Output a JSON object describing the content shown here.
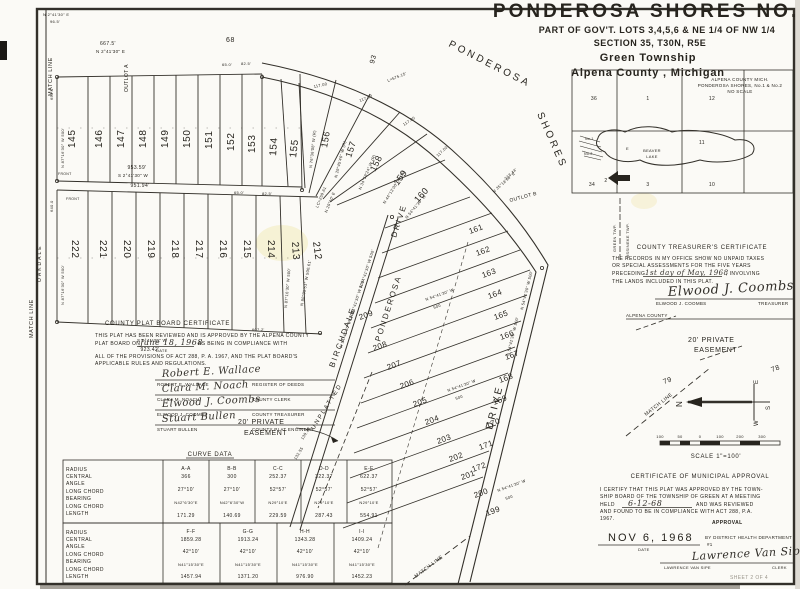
{
  "document": {
    "title_line1": "PONDEROSA   SHORES   NO. 2",
    "title_line2": "PART OF GOV'T. LOTS  3,4,5,6  &  NE 1/4  OF  NW 1/4",
    "title_line3": "SECTION  35,  T30N, R5E",
    "title_line4": "Green   Township",
    "title_line5": "Alpena  County ,  Michigan",
    "sheet_note": "SHEET 2 OF 4"
  },
  "inset_map": {
    "caption1": "ALPENA  COUNTY  MICH.",
    "caption2": "PONDEROSA  SHORES, No.1 & No.2",
    "caption3": "NO SCALE",
    "lake_dir": "E",
    "lake_name1": "BEAVER",
    "lake_name2": "LAKE",
    "plat_no1": "No.1",
    "plat_no2": "No.2",
    "sections": [
      "36",
      "1",
      "12",
      "11",
      "34",
      "2",
      "3",
      "10"
    ]
  },
  "certificates": {
    "treasurer": {
      "heading": "COUNTY  TREASURER'S  CERTIFICATE",
      "body1": "THE RECORDS IN MY OFFICE SHOW NO UNPAID TAXES",
      "body2": "OR SPECIAL ASSESSMENTS FOR THE FIVE YEARS",
      "body3_pre": "PRECEDING",
      "body3_date": "1st day of May, 1968",
      "body3_post": ", INVOLVING",
      "body4": "THE LANDS INCLUDED IN THIS PLAT.",
      "signature": "Elwood J. Coombs",
      "name": "ELWOOD  J.  COOMBS",
      "title": "TREASURER",
      "county": "ALPENA COUNTY"
    },
    "plat_board": {
      "heading": "COUNTY  PLAT  BOARD  CERTIFICATE",
      "body1": "THIS PLAT HAS BEEN REVIEWED AND IS APPROVED BY THE ALPENA COUNTY",
      "body2_pre": "PLAT BOARD ON",
      "body2_date": "June 18, 1968",
      "body2_date_label": "DATE",
      "body2_post": "AS BEING IN COMPLIANCE WITH",
      "body3": "ALL OF THE PROVISIONS OF ACT 288, P. A. 1967, AND THE PLAT BOARD'S",
      "body4": "APPLICABLE RULES AND REGULATIONS.",
      "signers": [
        {
          "signature": "Robert E. Wallace",
          "name": "ROBERT  E.  WALLACE",
          "title": "REGISTER  OF  DEEDS"
        },
        {
          "signature": "Clara M. Noach",
          "name": "CLARA  M.  NOACH",
          "title": "COUNTY  CLERK"
        },
        {
          "signature": "Elwood J. Coombs",
          "name": "ELWOOD  J.  COOMBS",
          "title": "COUNTY  TREASURER"
        },
        {
          "signature": "Stuart Bullen",
          "name": "STUART  BULLEN",
          "title": "COUNTY  PLAT  ENGINEER"
        }
      ]
    },
    "municipal": {
      "heading": "CERTIFICATE  OF  MUNICIPAL  APPROVAL",
      "body1": "I CERTIFY THAT THIS PLAT WAS APPROVED BY THE TOWN-",
      "body2": "SHIP BOARD OF THE TOWNSHIP OF GREEN AT A MEETING",
      "body3_pre": "HELD",
      "body3_date": "6-12-68",
      "body3_post": "AND WAS REVIEWED",
      "body4": "AND FOUND TO BE IN COMPLIANCE WITH ACT 288, P.A.",
      "body5": "1967.",
      "approval": "APPROVAL",
      "date_value": "NOV 6, 1968",
      "date_label": "DATE",
      "by_line1": "BY DISTRICT HEALTH DEPARTMENT",
      "by_line2": "#1",
      "signature": "Lawrence Van Sipe",
      "name": "LAWRENCE  VAN  SIPE",
      "title": "CLERK"
    }
  },
  "curve_table": {
    "title": "CURVE  DATA",
    "row_labels": [
      "RADIUS",
      "CENTRAL",
      "ANGLE",
      "LONG CHORD",
      "BEARING",
      "LONG CHORD",
      "LENGTH"
    ],
    "group1": {
      "headers": [
        "A-A",
        "B-B",
        "C-C",
        "D-D",
        "E-E"
      ],
      "radius": [
        "366",
        "300",
        "252.37",
        "322.37",
        "622.37"
      ],
      "central_angle": [
        "27°10'",
        "27°10'",
        "52°57'",
        "52°57'",
        "52°57'"
      ],
      "long_chord_bearing": [
        "N42°6'30\"E",
        "N42°6'30\"W",
        "N29°10'E",
        "N29°10'E",
        "N29°10'E"
      ],
      "long_chord_length": [
        "171.29",
        "140.69",
        "229.59",
        "287.43",
        "554.91"
      ]
    },
    "group2": {
      "headers": [
        "F-F",
        "G-G",
        "H-H",
        "I-I"
      ],
      "radius": [
        "1859.28",
        "1913.24",
        "1343.28",
        "1409.24"
      ],
      "central_angle": [
        "42°10'",
        "42°10'",
        "42°10'",
        "42°10'"
      ],
      "long_chord_bearing": [
        "N41°15'30\"E",
        "N41°15'30\"E",
        "N41°15'30\"E",
        "N41°15'30\"E"
      ],
      "long_chord_length": [
        "1457.94",
        "1371.20",
        "976.90",
        "1452.23"
      ]
    }
  },
  "compass": {
    "n": "N",
    "e": "E",
    "s": "S",
    "w": "W"
  },
  "scale_bar": {
    "label": "SCALE  1\"=100'",
    "ticks": [
      "100",
      "50",
      "0",
      "100",
      "200",
      "300"
    ]
  },
  "streets": {
    "ponderosa_top": "PONDEROSA",
    "shores": "SHORES",
    "drive_main": "DRIVE",
    "ponderosa_west": "PONDEROSA",
    "drive_west": "DRIVE",
    "birchdale": "BIRCHDALE",
    "oakdale": "OAKDALE"
  },
  "map_labels": {
    "match_line_left_top": "MATCH  LINE",
    "match_line_left_mid": "MATCH  LINE",
    "match_line_bottom": "MATCH  LINE",
    "match_line_right": "MATCH  LINE",
    "unplatted": "UNPLATTED",
    "easement_left_1": "20'  PRIVATE",
    "easement_left_2": "EASEMENT",
    "easement_right_1": "20'  PRIVATE",
    "easement_right_2": "EASEMENT",
    "outlot_a": "OUTLOT  A",
    "outlot_b": "OUTLOT  B",
    "green_twp": "GREEN  TWP.",
    "ossineke_twp": "OSSINEKE  TWP.",
    "front": "FRONT"
  },
  "lot_numbers": {
    "block1": [
      "145",
      "146",
      "147",
      "148",
      "149",
      "150",
      "151",
      "152",
      "153",
      "154",
      "155"
    ],
    "block2": [
      "222",
      "221",
      "220",
      "219",
      "218",
      "217",
      "216",
      "215",
      "214",
      "213",
      "212"
    ],
    "fan": [
      "156",
      "157",
      "158",
      "159",
      "160"
    ],
    "column_a": [
      "161",
      "162",
      "163",
      "164",
      "165",
      "166",
      "167",
      "168",
      "169",
      "170",
      "171",
      "172"
    ],
    "column_b": [
      "199",
      "200",
      "201",
      "202",
      "203",
      "204",
      "205",
      "206",
      "207",
      "208",
      "209"
    ],
    "adjacent": [
      "68",
      "93",
      "78",
      "79"
    ]
  },
  "bearings": {
    "n2_41_30_e": "N 2°41'30\" E",
    "s2_41_30_w": "S 2°41'30\" W",
    "n87_16_30_w_500": "N 87°16'30\" W  500'",
    "n88_05_51_w": "N 88°05'51\" W  500.61'",
    "n54_41_30_w": "N 54°41'30\" W",
    "n54_41_30_w_500": "N 54°41'30\" W  500'",
    "n35_18_30_e": "N 35°18'30\" E",
    "n29_45_46_w": "N 29°45'46\" W (R)",
    "n34_59_24_w": "N 34°59'24\" W (R)",
    "n44_13_00_w": "N 44°13'00\" W (R)",
    "n76_36_08_w": "N 76°36'08\" W (R)",
    "n29_10_e": "N 29°10' E"
  },
  "measurements": {
    "d667_5": "667.5'",
    "d96_5": "96.5'",
    "d953_59": "953.59'",
    "d951_94": "951.94'",
    "d923_42": "923.42'",
    "d117_00": "117.00",
    "arc_l": "L=575.15'",
    "lc_259_61": "LC=259.61",
    "d65_0": "65.0'",
    "d82_5": "82.5'",
    "d650": "650.0",
    "d640": "640.0",
    "d607_2": "607.2'",
    "d213_44": "213.44'",
    "d500": "500",
    "d139_38": "139.38",
    "d132_55": "132.55"
  }
}
